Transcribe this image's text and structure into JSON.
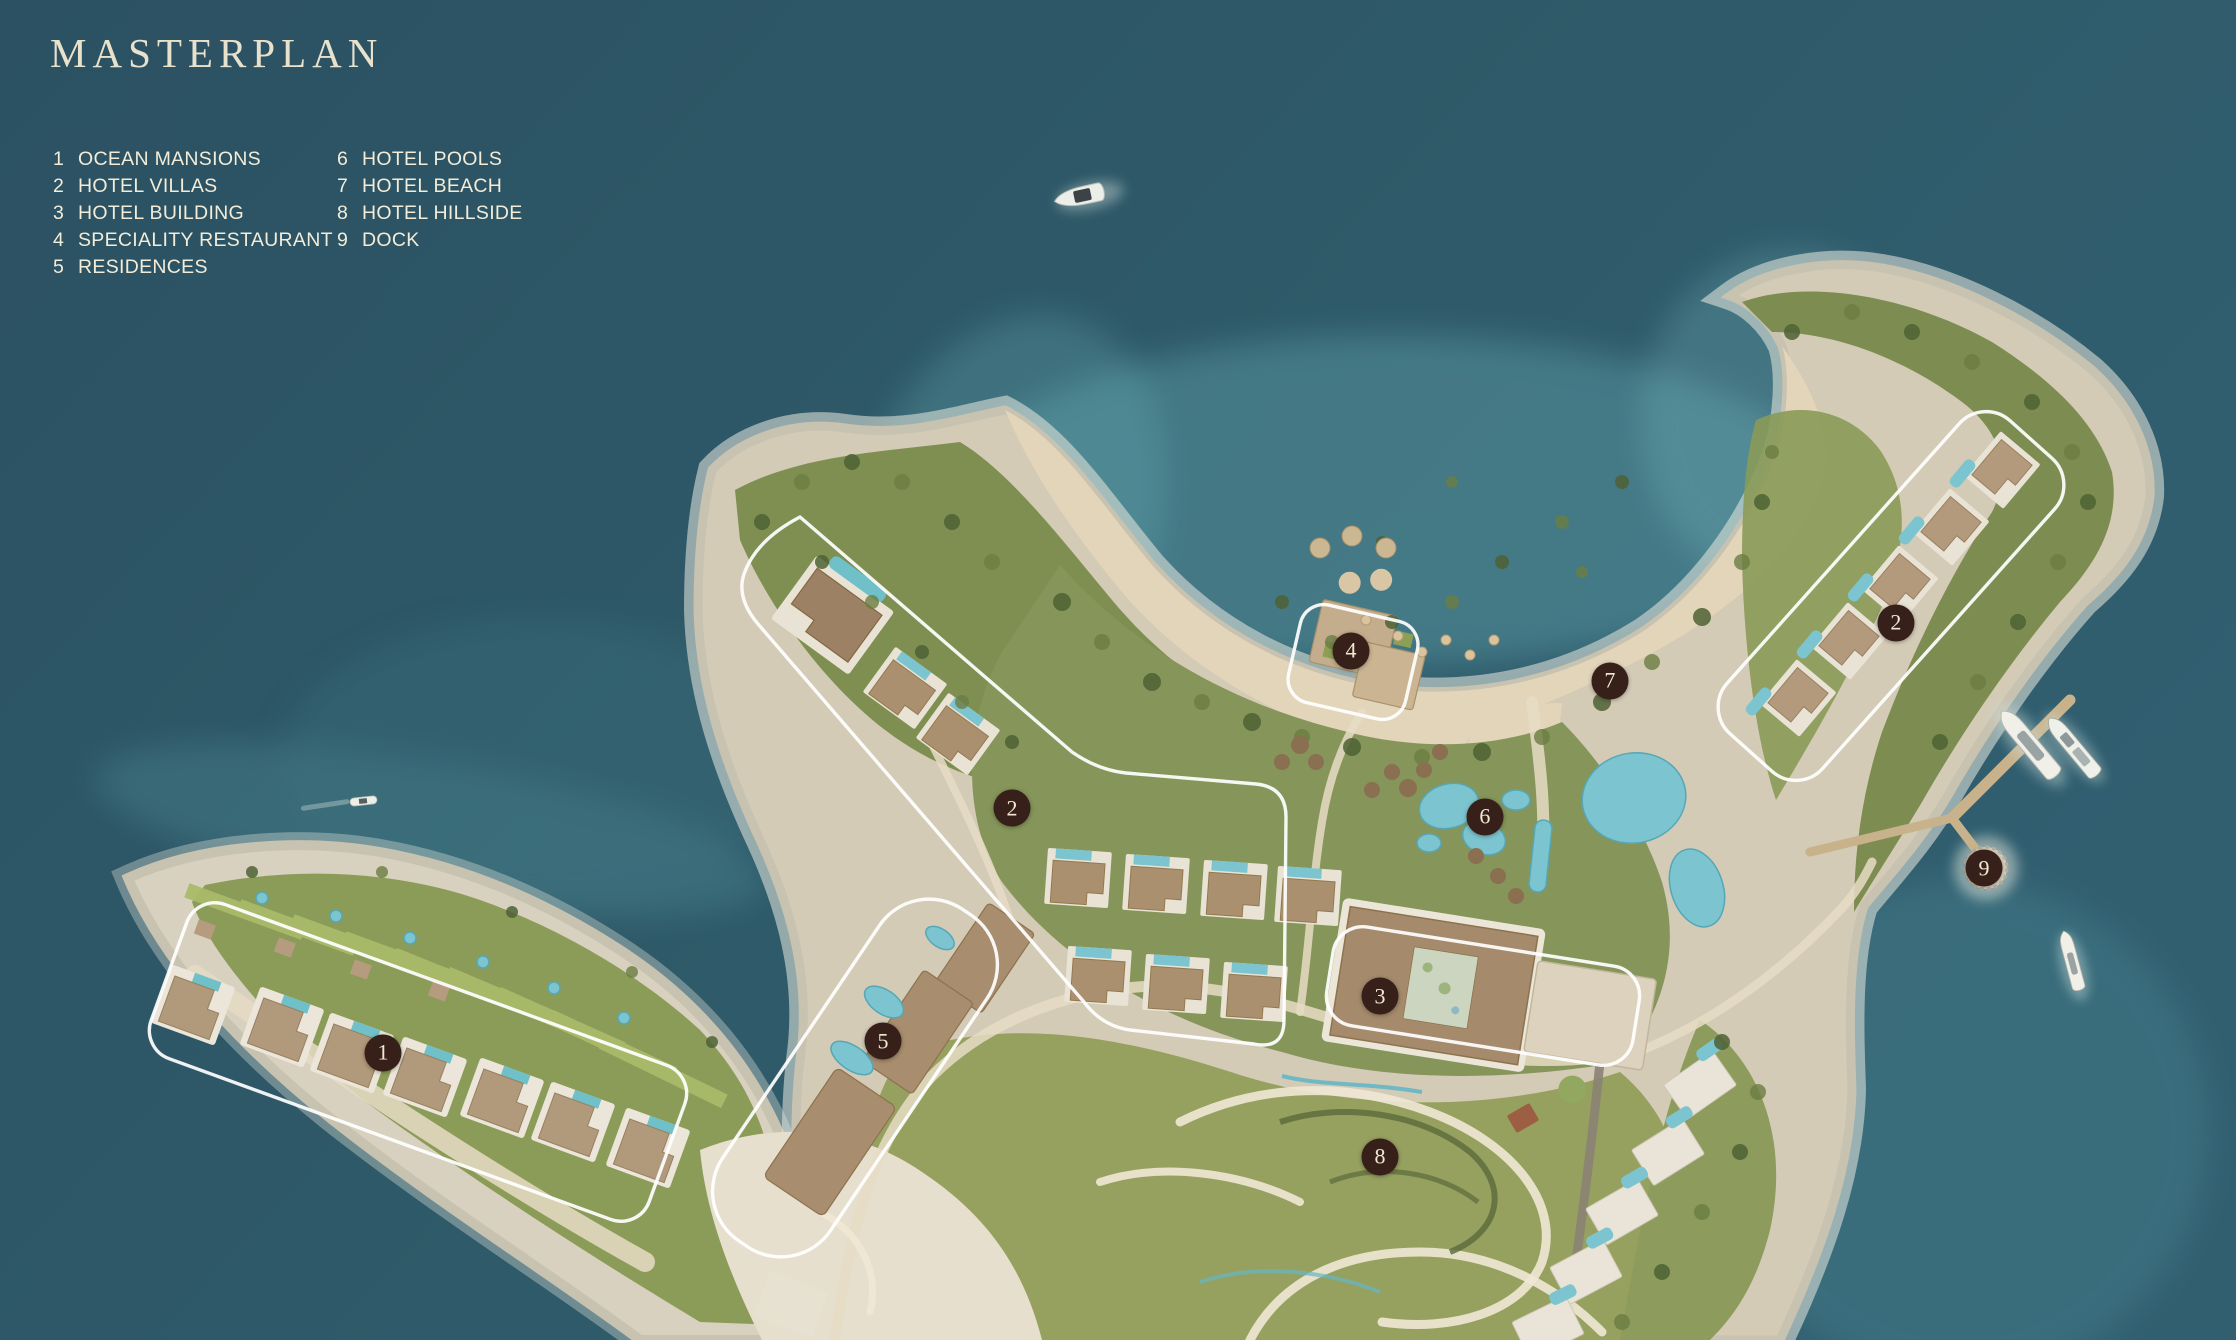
{
  "title": "MASTERPLAN",
  "theme": {
    "title_color": "#e8e1cc",
    "legend_color": "#f2ecd8",
    "marker_bg": "#362019",
    "marker_text": "#f1e8d4",
    "zone_outline": "#ffffff",
    "ocean_deep": "#2b5162",
    "ocean_light": "#315f70",
    "sand": "#e2d5ba",
    "pool_blue": "#7cc4cf"
  },
  "legend": {
    "items": [
      {
        "num": "1",
        "label": "OCEAN MANSIONS",
        "column": 1
      },
      {
        "num": "2",
        "label": "HOTEL VILLAS",
        "column": 1
      },
      {
        "num": "3",
        "label": "HOTEL BUILDING",
        "column": 1
      },
      {
        "num": "4",
        "label": "SPECIALITY RESTAURANT",
        "column": 1
      },
      {
        "num": "5",
        "label": "RESIDENCES",
        "column": 1
      },
      {
        "num": "6",
        "label": "HOTEL POOLS",
        "column": 2
      },
      {
        "num": "7",
        "label": "HOTEL BEACH",
        "column": 2
      },
      {
        "num": "8",
        "label": "HOTEL HILLSIDE",
        "column": 2
      },
      {
        "num": "9",
        "label": "DOCK",
        "column": 2
      }
    ]
  },
  "markers": [
    {
      "num": "1",
      "label": "OCEAN MANSIONS",
      "x": 17.13,
      "y": 78.58
    },
    {
      "num": "2",
      "label": "HOTEL VILLAS",
      "x": 45.26,
      "y": 60.3
    },
    {
      "num": "2",
      "label": "HOTEL VILLAS",
      "x": 84.79,
      "y": 46.49
    },
    {
      "num": "3",
      "label": "HOTEL BUILDING",
      "x": 61.72,
      "y": 74.33
    },
    {
      "num": "4",
      "label": "SPECIALITY RESTAURANT",
      "x": 60.42,
      "y": 48.58
    },
    {
      "num": "5",
      "label": "RESIDENCES",
      "x": 39.49,
      "y": 77.69
    },
    {
      "num": "6",
      "label": "HOTEL POOLS",
      "x": 66.41,
      "y": 60.97
    },
    {
      "num": "7",
      "label": "HOTEL BEACH",
      "x": 72.0,
      "y": 50.82
    },
    {
      "num": "8",
      "label": "HOTEL HILLSIDE",
      "x": 61.72,
      "y": 86.34
    },
    {
      "num": "9",
      "label": "DOCK",
      "x": 88.73,
      "y": 64.78
    }
  ]
}
